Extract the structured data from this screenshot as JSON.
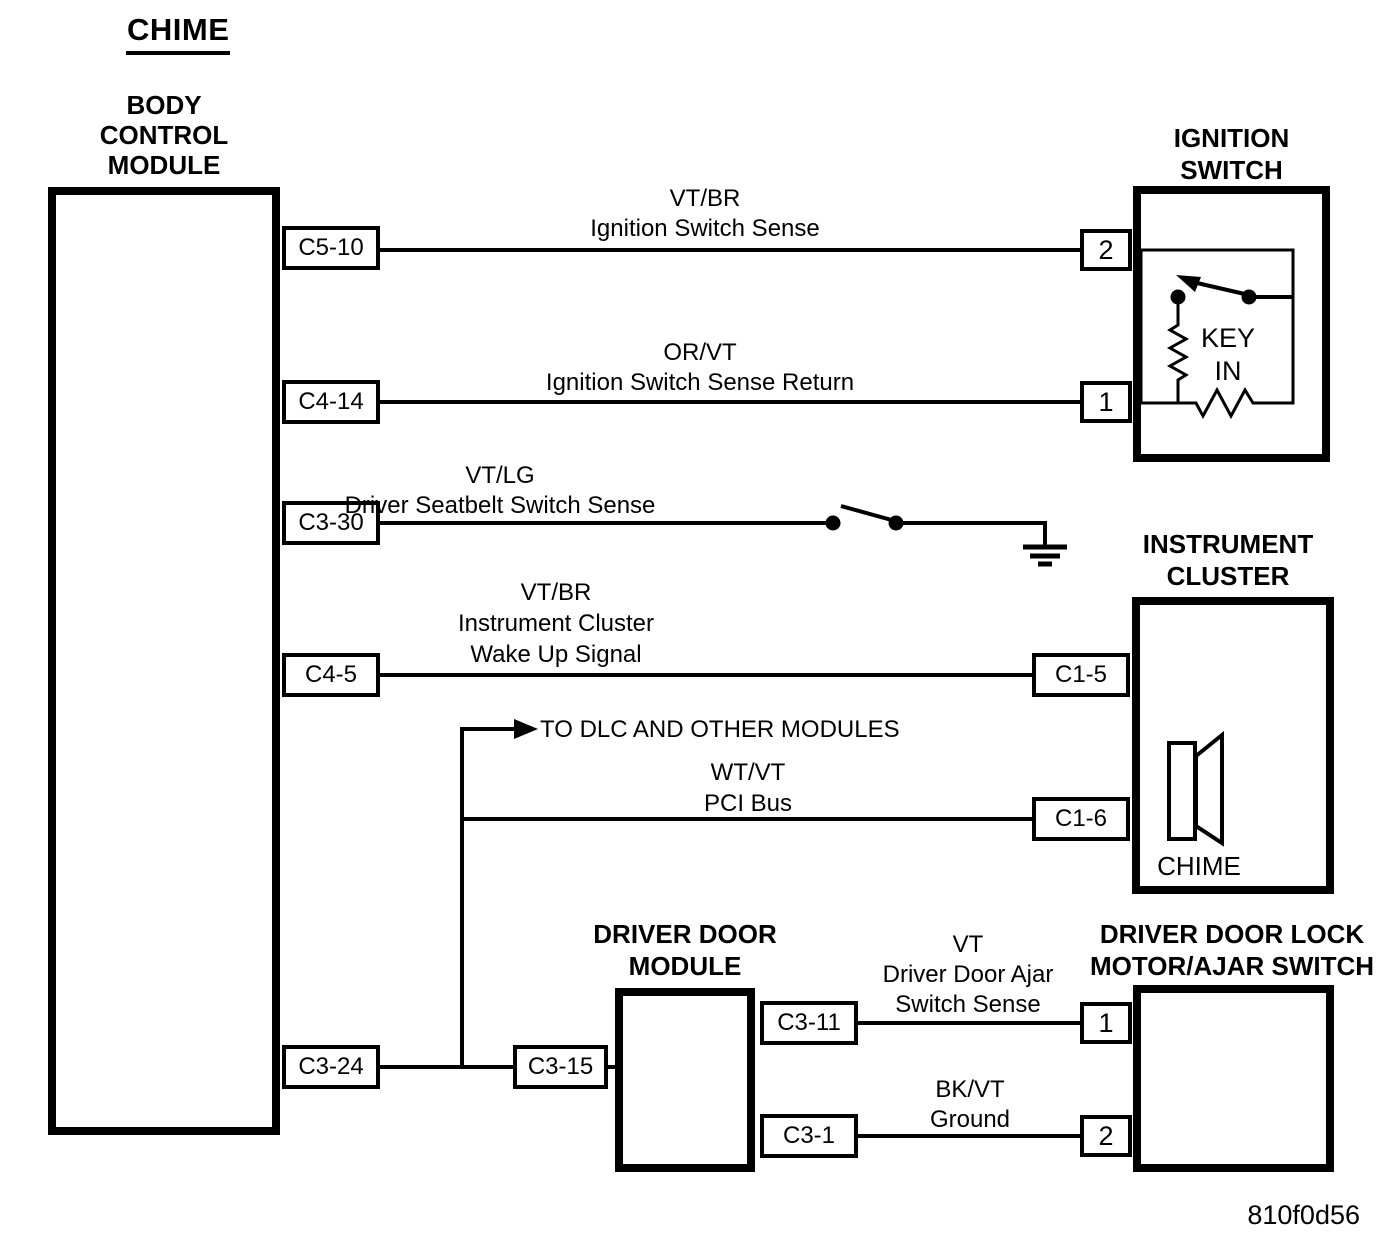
{
  "diagram": {
    "title": "CHIME",
    "figure_id": "810f0d56",
    "ink_color": "#000000",
    "background_color": "#ffffff"
  },
  "bcm": {
    "name_lines": [
      "BODY",
      "CONTROL",
      "MODULE"
    ],
    "connectors": [
      {
        "id": "C5-10"
      },
      {
        "id": "C4-14"
      },
      {
        "id": "C3-30"
      },
      {
        "id": "C4-5"
      },
      {
        "id": "C3-24"
      }
    ]
  },
  "ignition_switch": {
    "name_lines": [
      "IGNITION",
      "SWITCH"
    ],
    "terminals": [
      {
        "id": "2"
      },
      {
        "id": "1"
      }
    ],
    "key_in_lines": [
      "KEY",
      "IN"
    ]
  },
  "instrument_cluster": {
    "name_lines": [
      "INSTRUMENT",
      "CLUSTER"
    ],
    "connectors": [
      {
        "id": "C1-5"
      },
      {
        "id": "C1-6"
      }
    ],
    "speaker_label": "CHIME"
  },
  "driver_door_module": {
    "name_lines": [
      "DRIVER DOOR",
      "MODULE"
    ],
    "left_connector": {
      "id": "C3-15"
    },
    "right_connectors": [
      {
        "id": "C3-11"
      },
      {
        "id": "C3-1"
      }
    ]
  },
  "door_lock_switch": {
    "name_lines": [
      "DRIVER DOOR LOCK",
      "MOTOR/AJAR SWITCH"
    ],
    "terminals": [
      {
        "id": "1"
      },
      {
        "id": "2"
      }
    ]
  },
  "wires": {
    "ignition_sense": {
      "color_code": "VT/BR",
      "label": "Ignition Switch Sense"
    },
    "ignition_sense_return": {
      "color_code": "OR/VT",
      "label": "Ignition Switch Sense Return"
    },
    "seatbelt_sense": {
      "color_code": "VT/LG",
      "label": "Driver Seatbelt Switch Sense"
    },
    "cluster_wake_up": {
      "color_code": "VT/BR",
      "label_lines": [
        "Instrument Cluster",
        "Wake Up Signal"
      ]
    },
    "pci_bus": {
      "color_code": "WT/VT",
      "label": "PCI Bus",
      "branch_note": "TO DLC AND OTHER MODULES"
    },
    "door_ajar_sense": {
      "color_code": "VT",
      "label_lines": [
        "Driver Door Ajar",
        "Switch Sense"
      ]
    },
    "door_ground": {
      "color_code": "BK/VT",
      "label": "Ground"
    }
  }
}
